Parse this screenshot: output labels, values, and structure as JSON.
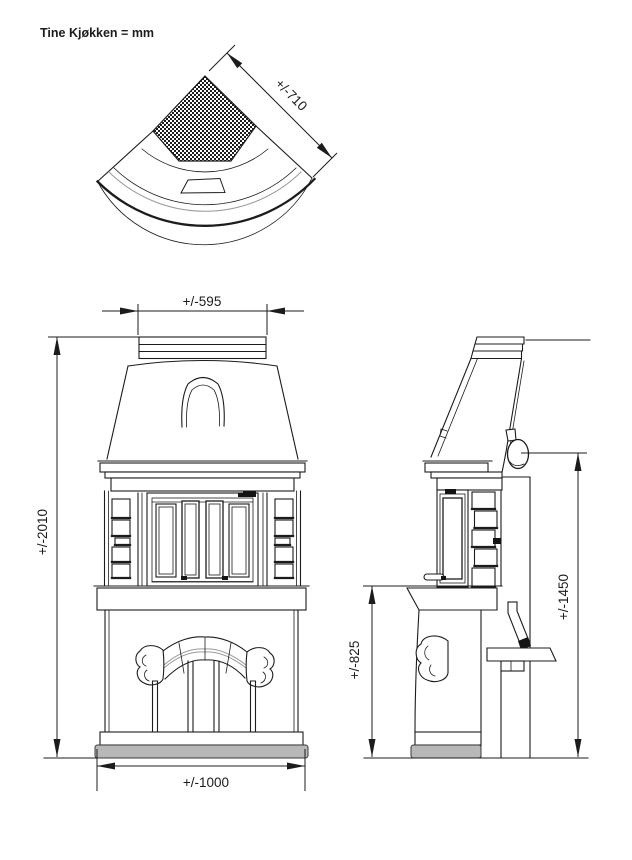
{
  "title": "Tine Kjøkken = mm",
  "dimensions": {
    "top_diagonal_width": "+/-710",
    "front_top_width": "+/-595",
    "front_total_height": "+/-2010",
    "front_base_width": "+/-1000",
    "side_hearth_height": "+/-825",
    "side_flue_height": "+/-1450"
  },
  "colors": {
    "line": "#1c1c1c",
    "gray_line": "#9a9a9a",
    "plinth_gray": "#b8b8b8"
  }
}
